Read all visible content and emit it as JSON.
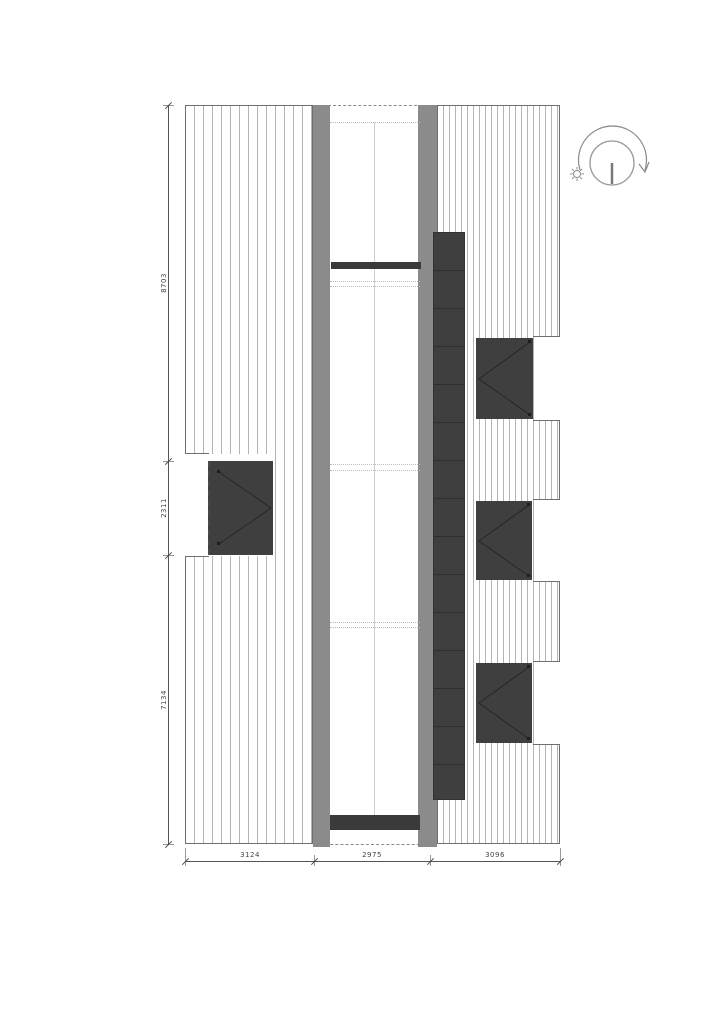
{
  "dimensions": {
    "bottom": [
      "3124",
      "2975",
      "3096"
    ],
    "left": [
      "8703",
      "2311",
      "7134"
    ]
  },
  "icons": {
    "sun_path": "sun-path-rotation-icon",
    "sun": "sun-icon",
    "arrow": "rotation-arrow-icon"
  },
  "colors": {
    "wall_gray": "#8b8b8b",
    "dark_element": "#3f3f3f",
    "beam_dark": "#3a3a3a",
    "hatch_line": "#b4b4b4",
    "outline": "#6f6f6f",
    "dimension": "#444444",
    "background": "#ffffff"
  }
}
